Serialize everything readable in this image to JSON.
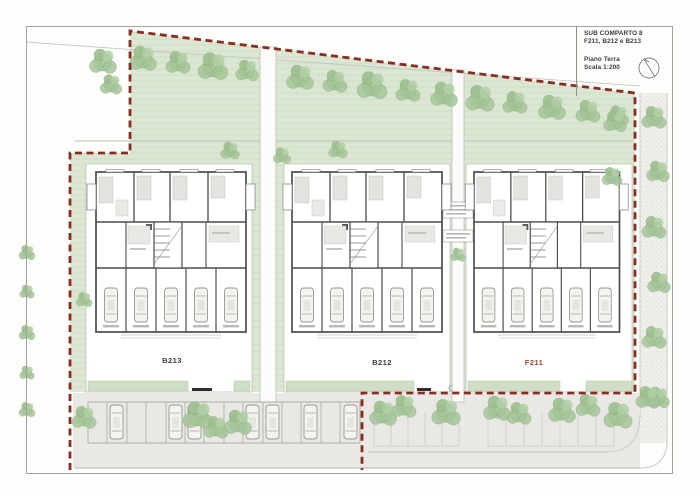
{
  "title_block": {
    "project": "SUB COMPARTO 8",
    "buildings_line": "F211, B212 e B213",
    "floor": "Piano Terra",
    "scale": "Scala 1:200"
  },
  "building_labels": {
    "b213": "B213",
    "b212": "B212",
    "f211": "F211"
  },
  "icons": {
    "north": "north-arrow-icon"
  },
  "colors": {
    "boundary-red": "#8a2c1f",
    "f211-red": "#b5432c",
    "lawn-green": "#dce7d3",
    "tree-green": "#a5c599",
    "tree-edge": "#8cb180",
    "pavement": "#e9e8e4",
    "path-gray": "#efeeea",
    "wall-dark": "#4c4c4c",
    "hedge-green": "#cfdfc5",
    "label-dark": "#3c3c3c",
    "frame-gray": "#a2a29e",
    "line-gray": "#bdbdb8"
  }
}
